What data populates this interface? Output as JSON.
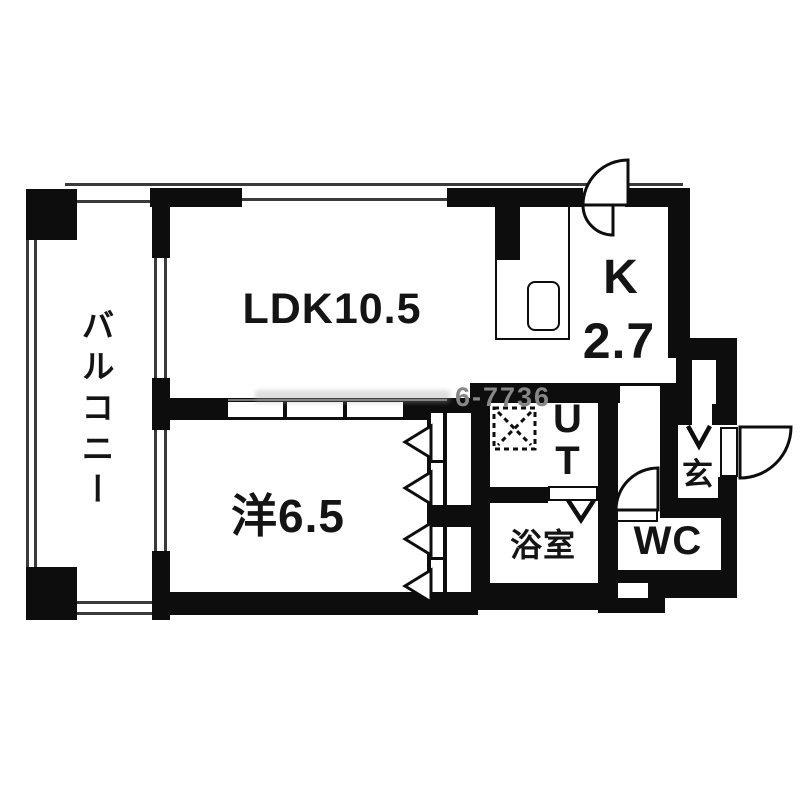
{
  "floor_plan": {
    "title": "apartment-floor-plan",
    "rooms": {
      "balcony": {
        "label": "バルコニー"
      },
      "ldk": {
        "label": "LDK10.5"
      },
      "kitchen": {
        "letter": "K",
        "size": "2.7"
      },
      "western_room": {
        "label": "洋6.5"
      },
      "utility": {
        "line1": "U",
        "line2": "T"
      },
      "bathroom": {
        "label": "浴室"
      },
      "toilet": {
        "label": "WC"
      },
      "entrance": {
        "label": "玄"
      }
    },
    "watermark": {
      "visible_text": "6-7736"
    },
    "colors": {
      "wall": "#0d0d0d",
      "floor": "#ffffff",
      "thin_line": "#3a3a3a",
      "watermark": "#878787"
    }
  }
}
